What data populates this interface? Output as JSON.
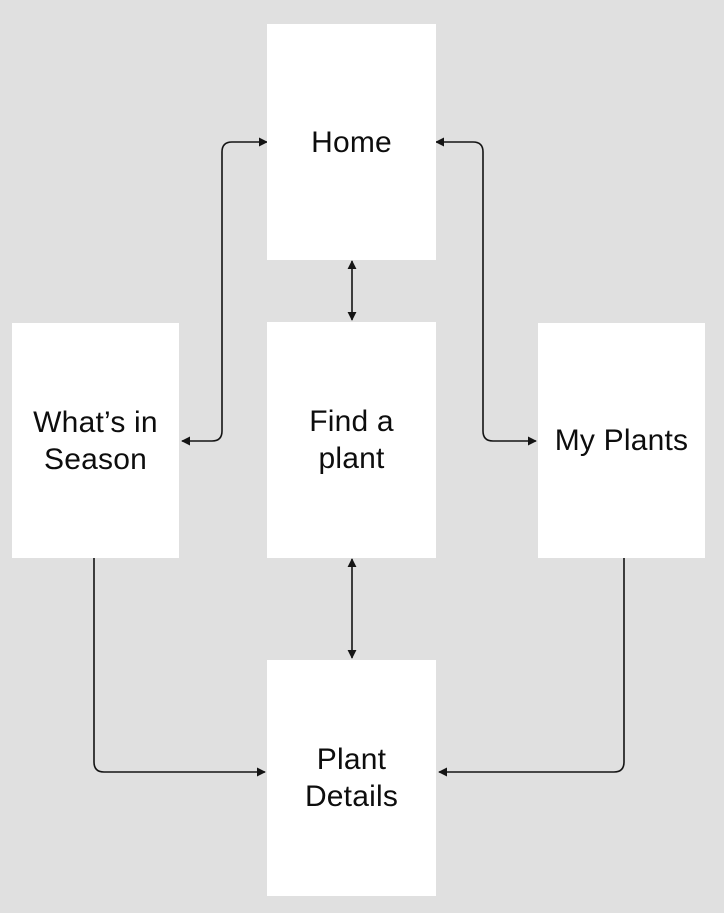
{
  "canvas": {
    "width": 724,
    "height": 913,
    "background": "#e0e0e0"
  },
  "style": {
    "node_fill": "#ffffff",
    "text_color": "#0d0d0d",
    "line_color": "#141414"
  },
  "nodes": [
    {
      "id": "home",
      "label": "Home",
      "x": 267,
      "y": 24,
      "w": 169,
      "h": 236
    },
    {
      "id": "whats-in-season",
      "label": "What’s in\nSeason",
      "x": 12,
      "y": 323,
      "w": 167,
      "h": 235
    },
    {
      "id": "find-a-plant",
      "label": "Find a\nplant",
      "x": 267,
      "y": 322,
      "w": 169,
      "h": 236
    },
    {
      "id": "my-plants",
      "label": "My Plants",
      "x": 538,
      "y": 323,
      "w": 167,
      "h": 235
    },
    {
      "id": "plant-details",
      "label": "Plant\nDetails",
      "x": 267,
      "y": 660,
      "w": 169,
      "h": 236
    }
  ],
  "edges": [
    {
      "from": "home",
      "to": "whats-in-season",
      "direction": "both",
      "path": "M 267 142 H 232 Q 222 142 222 152 V 431 Q 222 441 212 441 H 182"
    },
    {
      "from": "home",
      "to": "my-plants",
      "direction": "both",
      "path": "M 436 142 H 473 Q 483 142 483 152 V 431 Q 483 441 493 441 H 536"
    },
    {
      "from": "home",
      "to": "find-a-plant",
      "direction": "both",
      "path": "M 352 261 V 320"
    },
    {
      "from": "find-a-plant",
      "to": "plant-details",
      "direction": "both",
      "path": "M 352 559 V 658"
    },
    {
      "from": "whats-in-season",
      "to": "plant-details",
      "direction": "forward",
      "path": "M 94 558 V 762 Q 94 772 104 772 H 265"
    },
    {
      "from": "my-plants",
      "to": "plant-details",
      "direction": "forward",
      "path": "M 624 558 V 762 Q 624 772 614 772 H 439"
    }
  ]
}
